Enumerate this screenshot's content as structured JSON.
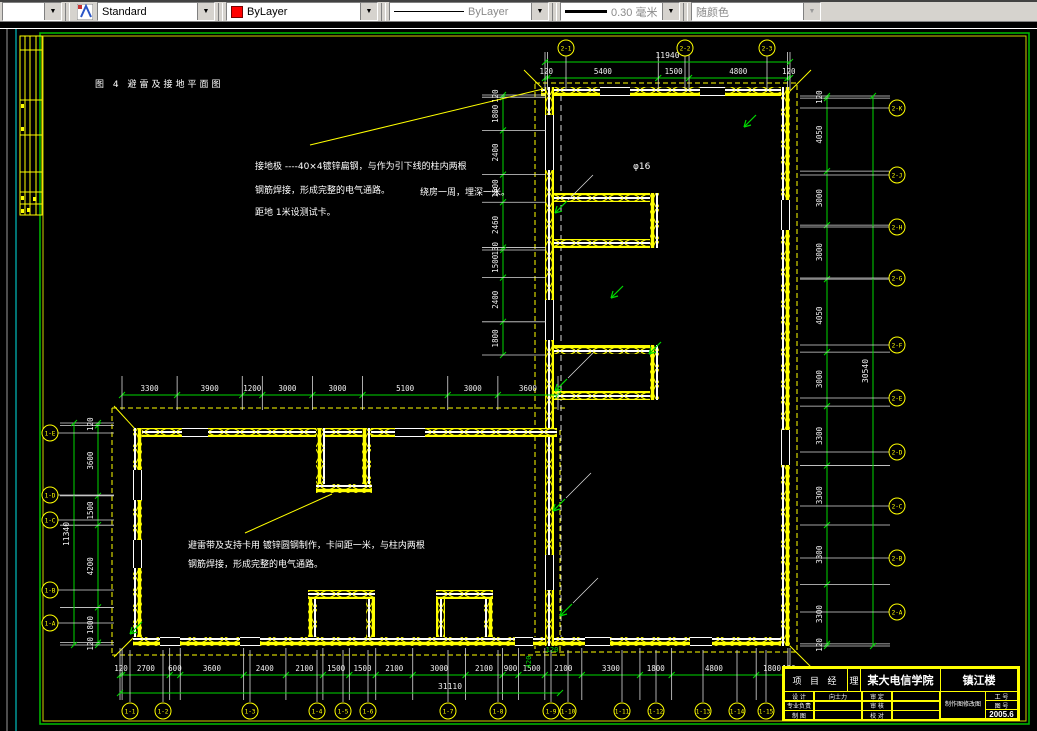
{
  "toolbar": {
    "style_value": "Standard",
    "color_value": "ByLayer",
    "linetype_value": "ByLayer",
    "lineweight_value": "0.30 毫米",
    "plotstyle_value": "随颜色"
  },
  "drawing": {
    "figure_title": "图 4  避雷及接地平面图",
    "note1_line1": "接地极 ----40×4镀锌扁钢，与作为引下线的柱内两根",
    "note1_phi": "φ16",
    "note1_line2": "钢筋焊接，形成完整的电气通路。",
    "note1_line2b": "绕房一周，埋深一米。",
    "note1_line3": "距地  1米设测试卡。",
    "note2_line1": "避雷带及支持卡用    镀锌圆钢制作，卡间距一米，与柱内两根",
    "note2_line2": "钢筋焊接，形成完整的电气通路。"
  },
  "dimensions": {
    "top": {
      "total": "11940",
      "segments": [
        "120",
        "5400",
        "1500",
        "4800",
        "120"
      ]
    },
    "right": {
      "total": "30540",
      "segments": [
        "120",
        "4050",
        "3000",
        "3000",
        "4050",
        "3000",
        "3300",
        "3300",
        "3300",
        "3300",
        "120"
      ]
    },
    "inner_left": {
      "segments": [
        "120",
        "1800",
        "2400",
        "1500",
        "2460",
        "130",
        "1500",
        "2400",
        "1800"
      ]
    },
    "left_top": {
      "segments": [
        "3300",
        "3900",
        "1200",
        "3000",
        "3000",
        "5100",
        "3000",
        "3600"
      ]
    },
    "left_side": {
      "total": "11340",
      "segments": [
        "120",
        "3600",
        "1500",
        "4200",
        "1800",
        "120"
      ]
    },
    "bottom": {
      "total": "31110",
      "segments": [
        "120",
        "2700",
        "600",
        "3600",
        "2400",
        "2100",
        "1500",
        "1500",
        "2100",
        "3000",
        "2100",
        "900",
        "1500",
        "2100",
        "3300",
        "1800",
        "4800",
        "1800",
        "120"
      ]
    },
    "misc": [
      "420",
      "120"
    ]
  },
  "axes": {
    "top": [
      "2-1",
      "2-2",
      "2-3"
    ],
    "right": [
      "2-K",
      "2-J",
      "2-H",
      "2-G",
      "2-F",
      "2-E",
      "2-D",
      "2-C",
      "2-B",
      "2-A"
    ],
    "left": [
      "1-E",
      "1-D",
      "1-C",
      "1-B",
      "1-A"
    ],
    "bottom": [
      "1-1",
      "1-2",
      "1-3",
      "1-4",
      "1-5",
      "1-6",
      "1-7",
      "1-8",
      "1-9",
      "1-10",
      "1-11",
      "1-12",
      "1-13",
      "1-14",
      "1-15"
    ]
  },
  "titleblock": {
    "header_left": "项 目 经",
    "header_mid": "理",
    "project_name": "某大电信学院",
    "drawing_name": "镇江楼",
    "rows": [
      [
        "设 计",
        "向士力",
        "审 定",
        ""
      ],
      [
        "专业负责",
        "",
        "审 核",
        ""
      ],
      [
        "制 图",
        "",
        "校 对",
        ""
      ]
    ],
    "maker_line1": "制作图",
    "maker_line2": "修改图",
    "cell_no1": "工 号",
    "cell_no2": "图 号",
    "date": "2005.6"
  }
}
